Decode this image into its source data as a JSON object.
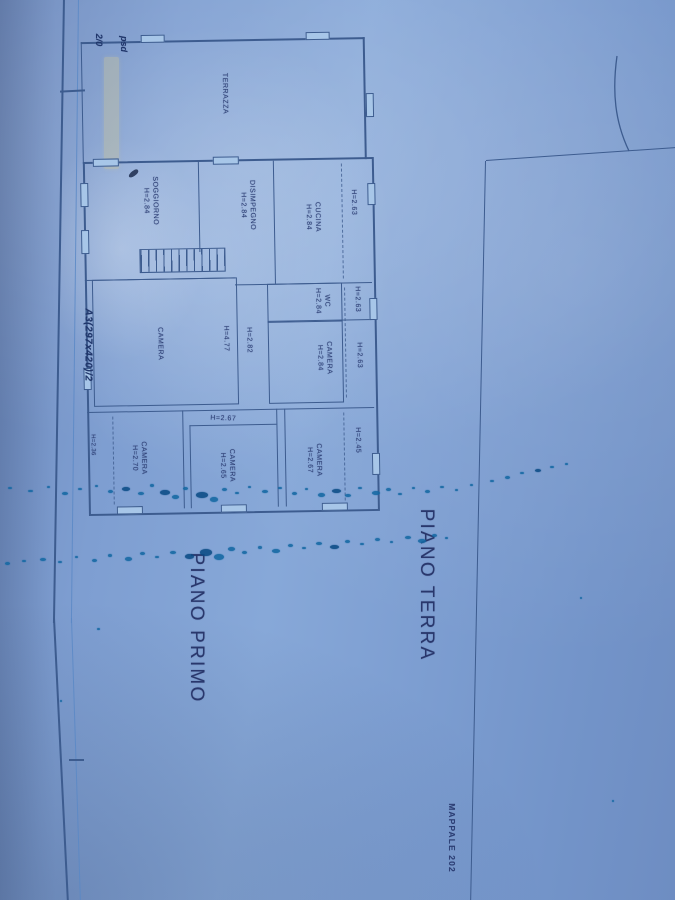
{
  "sheet": {
    "floor_label_ground": "PIANO TERRA",
    "floor_label_first": "PIANO PRIMO",
    "parcel_label": "MAPPALE 202",
    "handwritten_note_left_edge": "A3(297x420)/2",
    "handwritten_top_left_1": "2/0",
    "handwritten_top_left_2": "psd"
  },
  "rooms": {
    "terrazza": {
      "name": "TERRAZZA"
    },
    "soggiorno": {
      "name": "SOGGIORNO",
      "height": "H=2.84"
    },
    "disimpegno": {
      "name": "DISIMPEGNO",
      "height": "H=2.84"
    },
    "cucina": {
      "name": "CUCINA",
      "height": "H=2.84"
    },
    "wc": {
      "name": "WC",
      "height": "H=2.84"
    },
    "camera_grande": {
      "name": "CAMERA",
      "height": "H=4.77"
    },
    "camera_est": {
      "name": "CAMERA",
      "height": "H=2.84"
    },
    "camera_sud_ovest": {
      "name": "CAMERA",
      "height": "H=2.70"
    },
    "camera_sud_centro": {
      "name": "CAMERA",
      "height": "H=2.65"
    },
    "camera_sud_est": {
      "name": "CAMERA",
      "height": "H=2.67"
    }
  },
  "measurements": {
    "corridoio": "H=2.82",
    "sporto_cucina": "H=2.63",
    "sporto_wc": "H=2.63",
    "sporto_camera": "H=2.63",
    "sporto_sud_est": "H=2.45",
    "sporto_sud_ovest": "H=2.36",
    "portico": "H=2.67"
  },
  "colors": {
    "paper": "#7596cb",
    "drawing_line": "#3d5c8f",
    "label_text": "#2c3e74",
    "ink_splatter": "#1468a3"
  }
}
